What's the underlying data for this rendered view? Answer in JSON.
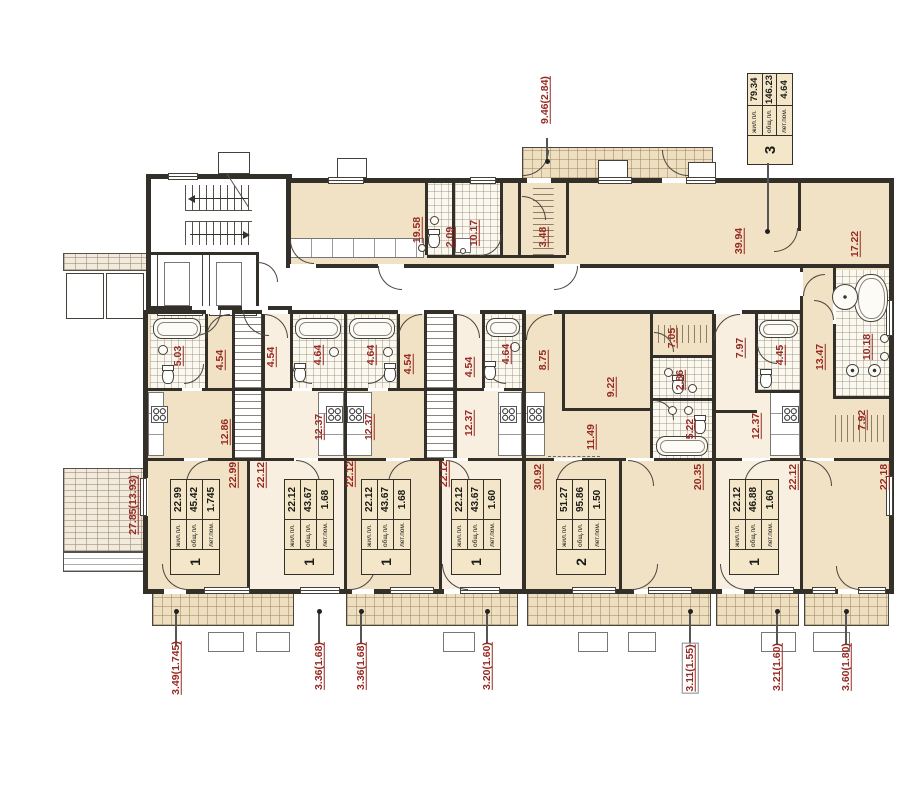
{
  "colors": {
    "accent_red": "#962a22",
    "room_beige": "#f1e2c5",
    "room_light": "#f8efe1",
    "wall": "#33302a"
  },
  "table_headers": {
    "living": "жил.пл.",
    "total": "общ.пл.",
    "summer": "лет.пом."
  },
  "info_table": {
    "apartment_number": "3",
    "rows": [
      {
        "label": "жил.пл.",
        "value": "79.34"
      },
      {
        "label": "общ.пл.",
        "value": "146.23"
      },
      {
        "label": "лет.пом.",
        "value": "4.64"
      }
    ]
  },
  "apartments": [
    {
      "number": "1",
      "living": "22.99",
      "total": "45.42",
      "summer": "1.745",
      "cx": 194,
      "cy": 526
    },
    {
      "number": "1",
      "living": "22.12",
      "total": "43.67",
      "summer": "1.68",
      "cx": 308,
      "cy": 526
    },
    {
      "number": "1",
      "living": "22.12",
      "total": "43.67",
      "summer": "1.68",
      "cx": 385,
      "cy": 526
    },
    {
      "number": "1",
      "living": "22.12",
      "total": "43.67",
      "summer": "1.60",
      "cx": 475,
      "cy": 526
    },
    {
      "number": "2",
      "living": "51.27",
      "total": "95.86",
      "summer": "1.50",
      "cx": 580,
      "cy": 526
    },
    {
      "number": "1",
      "living": "22.12",
      "total": "46.88",
      "summer": "1.60",
      "cx": 753,
      "cy": 526
    }
  ],
  "room_labels": [
    {
      "text": "19.58",
      "x": 417,
      "y": 230
    },
    {
      "text": "2.09",
      "x": 450,
      "y": 237
    },
    {
      "text": "10.17",
      "x": 474,
      "y": 233
    },
    {
      "text": "3.48",
      "x": 543,
      "y": 237
    },
    {
      "text": "39.94",
      "x": 739,
      "y": 241
    },
    {
      "text": "17.22",
      "x": 855,
      "y": 244
    },
    {
      "text": "5.03",
      "x": 178,
      "y": 356
    },
    {
      "text": "4.54",
      "x": 220,
      "y": 360
    },
    {
      "text": "4.54",
      "x": 271,
      "y": 357
    },
    {
      "text": "4.64",
      "x": 318,
      "y": 355
    },
    {
      "text": "4.64",
      "x": 371,
      "y": 355
    },
    {
      "text": "4.54",
      "x": 408,
      "y": 364
    },
    {
      "text": "4.54",
      "x": 469,
      "y": 367
    },
    {
      "text": "4.64",
      "x": 506,
      "y": 354
    },
    {
      "text": "8.75",
      "x": 543,
      "y": 360
    },
    {
      "text": "7.05",
      "x": 672,
      "y": 338
    },
    {
      "text": "2.86",
      "x": 680,
      "y": 380
    },
    {
      "text": "7.97",
      "x": 740,
      "y": 348
    },
    {
      "text": "4.45",
      "x": 780,
      "y": 355
    },
    {
      "text": "13.47",
      "x": 820,
      "y": 357
    },
    {
      "text": "10.18",
      "x": 867,
      "y": 347
    },
    {
      "text": "12.86",
      "x": 225,
      "y": 432
    },
    {
      "text": "12.37",
      "x": 319,
      "y": 427
    },
    {
      "text": "12.37",
      "x": 369,
      "y": 427
    },
    {
      "text": "12.37",
      "x": 469,
      "y": 423
    },
    {
      "text": "9.22",
      "x": 611,
      "y": 387
    },
    {
      "text": "11.49",
      "x": 591,
      "y": 437
    },
    {
      "text": "5.22",
      "x": 690,
      "y": 429
    },
    {
      "text": "12.37",
      "x": 756,
      "y": 426
    },
    {
      "text": "7.92",
      "x": 862,
      "y": 420
    },
    {
      "text": "22.99",
      "x": 233,
      "y": 475
    },
    {
      "text": "22.12",
      "x": 261,
      "y": 475
    },
    {
      "text": "22.12",
      "x": 350,
      "y": 474
    },
    {
      "text": "22.12",
      "x": 444,
      "y": 474
    },
    {
      "text": "30.92",
      "x": 538,
      "y": 477
    },
    {
      "text": "20.35",
      "x": 698,
      "y": 477
    },
    {
      "text": "22.12",
      "x": 793,
      "y": 477
    },
    {
      "text": "22.18",
      "x": 884,
      "y": 477
    }
  ],
  "dimension_labels": [
    {
      "text": "9.46(2.84)",
      "x": 545,
      "y": 100,
      "boxed": false
    },
    {
      "text": "27.85(13.93)",
      "x": 133,
      "y": 505,
      "boxed": false
    },
    {
      "text": "3.49(1.745)",
      "x": 176,
      "y": 668,
      "boxed": false
    },
    {
      "text": "3.36(1.68)",
      "x": 319,
      "y": 666,
      "boxed": false
    },
    {
      "text": "3.36(1.68)",
      "x": 361,
      "y": 666,
      "boxed": false
    },
    {
      "text": "3.20(1.60)",
      "x": 487,
      "y": 666,
      "boxed": false
    },
    {
      "text": "3.11(1.55)",
      "x": 690,
      "y": 668,
      "boxed": true
    },
    {
      "text": "3.21(1.60)",
      "x": 777,
      "y": 667,
      "boxed": false
    },
    {
      "text": "3.60(1.80)",
      "x": 846,
      "y": 667,
      "boxed": false
    }
  ]
}
